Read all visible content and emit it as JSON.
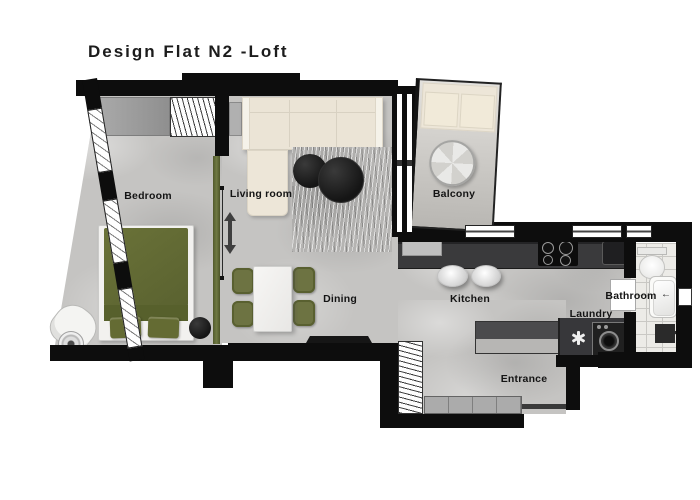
{
  "title": "Design Flat N2 -Loft",
  "rooms": {
    "bedroom": {
      "label": "Bedroom"
    },
    "living": {
      "label": "Living room"
    },
    "balcony": {
      "label": "Balcony"
    },
    "dining": {
      "label": "Dining"
    },
    "kitchen": {
      "label": "Kitchen"
    },
    "bathroom": {
      "label": "Bathroom"
    },
    "laundry": {
      "label": "Laundry"
    },
    "entrance": {
      "label": "Entrance"
    }
  },
  "icons": {
    "sliding_door": "double-arrow-vertical",
    "laundry_symbol": "asterisk",
    "shower_symbol": "arrow-left"
  },
  "colors": {
    "wall": "#0d0d0d",
    "floor": "#c5c4c2",
    "accent_olive": "#67703a",
    "sofa_cream": "#ebe4d6",
    "counter_dark": "#3a3a3c",
    "tile": "#ecebe7",
    "rug": "#b5b4b2",
    "coffee_table_black": "#1a1a1a"
  }
}
